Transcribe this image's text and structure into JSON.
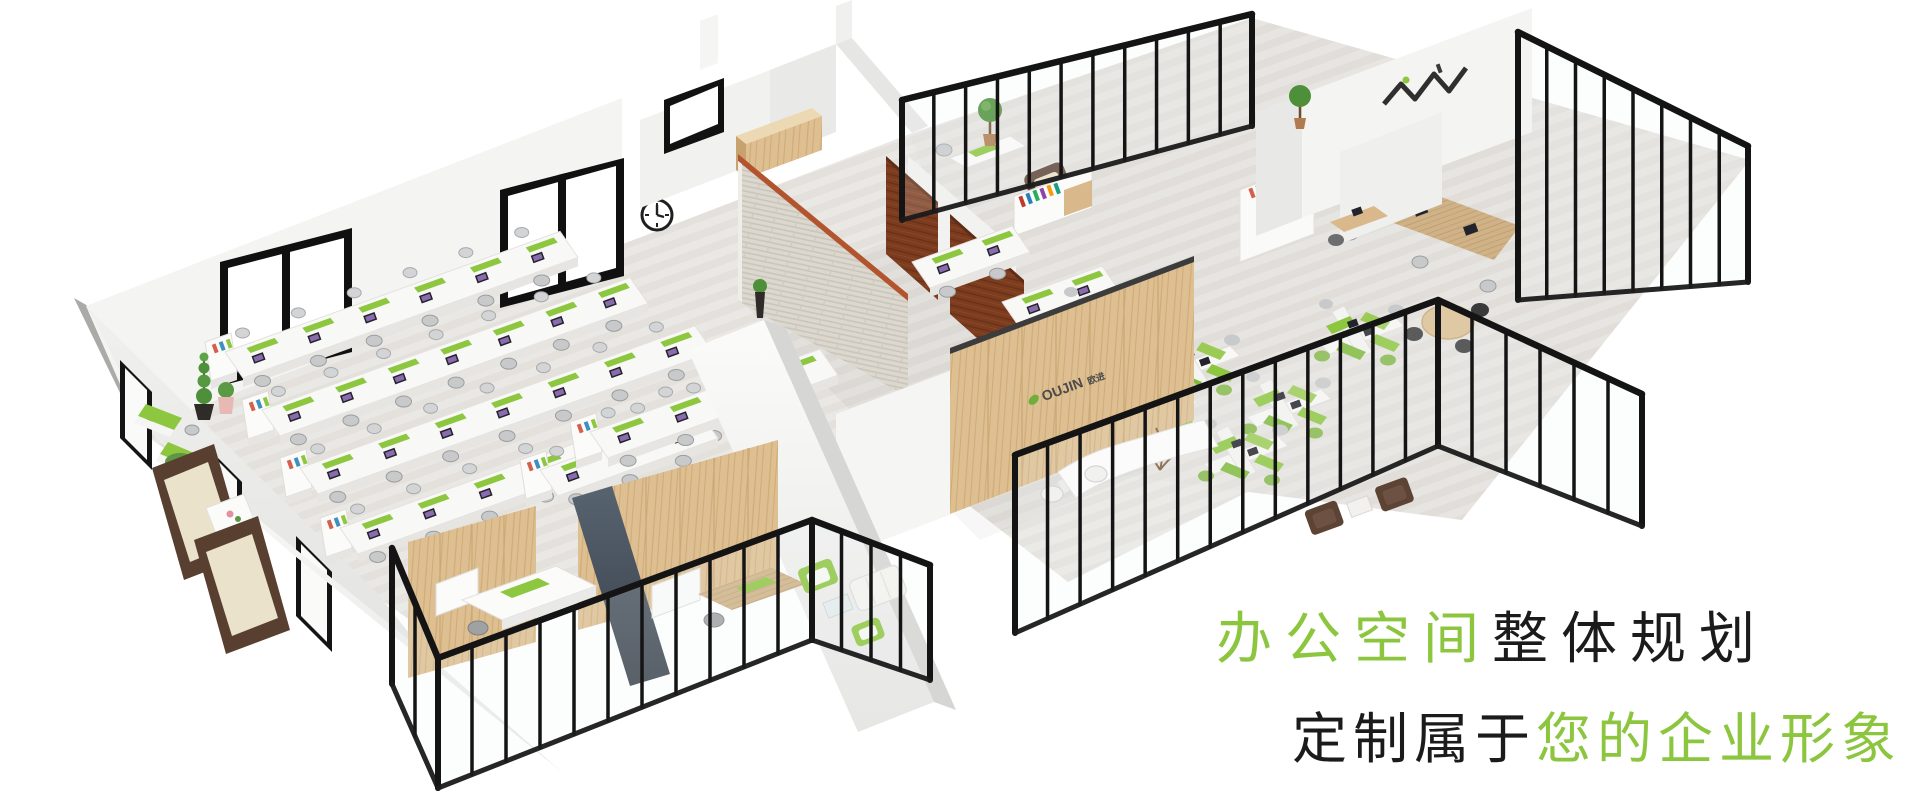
{
  "headline": {
    "line1": {
      "segments": [
        {
          "text": "办公空间",
          "color": "#8CC63F"
        },
        {
          "text": "整体规划",
          "color": "#1B1B1B"
        }
      ]
    },
    "line2": {
      "segments": [
        {
          "text": "定制属于",
          "color": "#1B1B1B"
        },
        {
          "text": "您的企业形象",
          "color": "#8CC63F"
        }
      ]
    }
  },
  "reception_logo": {
    "latin": "OUJIN",
    "cn": "欧进",
    "leaf_color": "#6FAE3B"
  },
  "palette": {
    "accent_green": "#8DC63F",
    "frame_black": "#161616",
    "light_wood": "#DDBF92",
    "mahogany": "#7C3C1E",
    "brick": "#DCD8CF",
    "brick_cap_orange": "#B2552E",
    "slate_wall": "#4E5A66",
    "sofa_brown": "#5C4334",
    "floor": "#EAE8E4",
    "wall_white": "#F4F4F2"
  }
}
